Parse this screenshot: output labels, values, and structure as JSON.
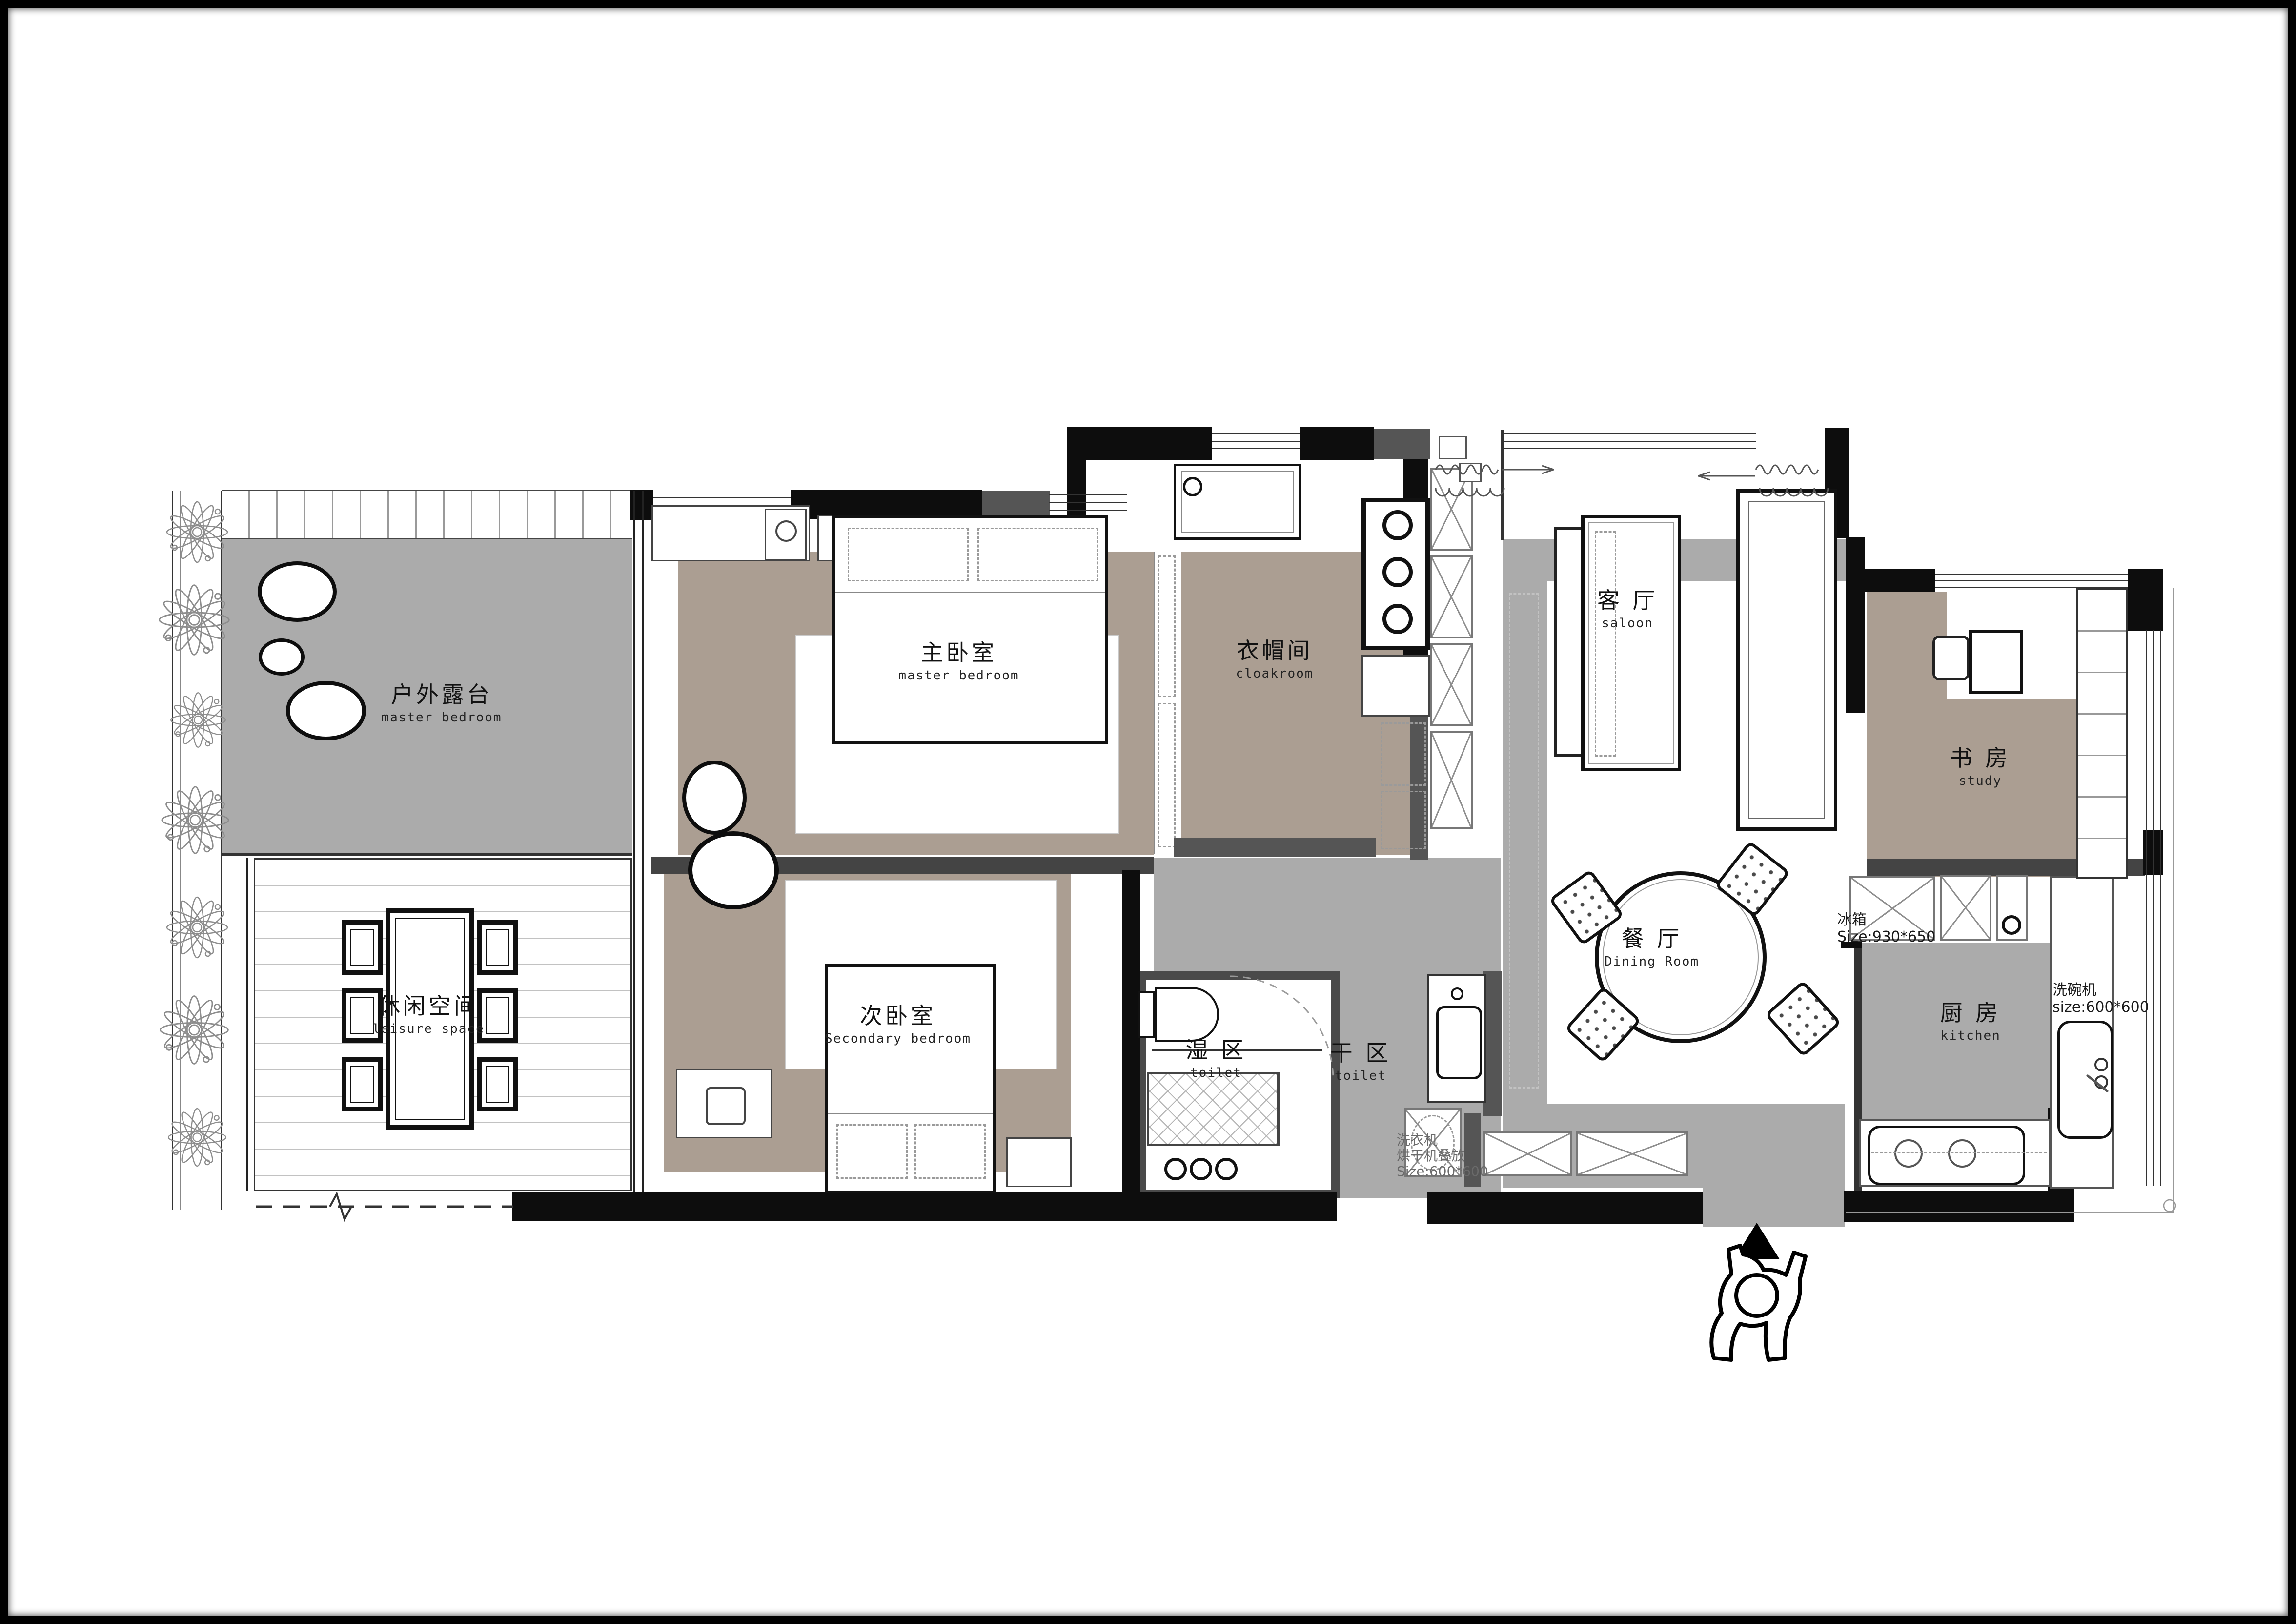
{
  "plan": {
    "rooms": {
      "terrace": {
        "cn": "户外露台",
        "en": "master bedroom"
      },
      "leisure": {
        "cn": "休闲空间",
        "en": "leisure space"
      },
      "master": {
        "cn": "主卧室",
        "en": "master bedroom"
      },
      "secondary": {
        "cn": "次卧室",
        "en": "Secondary bedroom"
      },
      "cloakroom": {
        "cn": "衣帽间",
        "en": "cloakroom"
      },
      "living": {
        "cn": "客 厅",
        "en": "saloon"
      },
      "dining": {
        "cn": "餐 厅",
        "en": "Dining Room"
      },
      "study": {
        "cn": "书 房",
        "en": "study"
      },
      "kitchen": {
        "cn": "厨 房",
        "en": "kitchen"
      },
      "wet": {
        "cn": "湿 区",
        "en": "toilet"
      },
      "dry": {
        "cn": "干 区",
        "en": "toilet"
      }
    },
    "annotations": {
      "fridge_line1": "冰箱",
      "fridge_line2": "Size:930*650",
      "dishwasher_line1": "洗碗机",
      "dishwasher_line2": "size:600*600",
      "washer_line1": "洗衣机",
      "washer_line2": "烘干机叠放",
      "washer_line3": "Size:600*600"
    },
    "colors": {
      "floor_taupe": "#ab9e92",
      "floor_gray": "#ababab",
      "wall_black": "#0d0d0d",
      "wall_dark_gray": "#555555"
    }
  }
}
